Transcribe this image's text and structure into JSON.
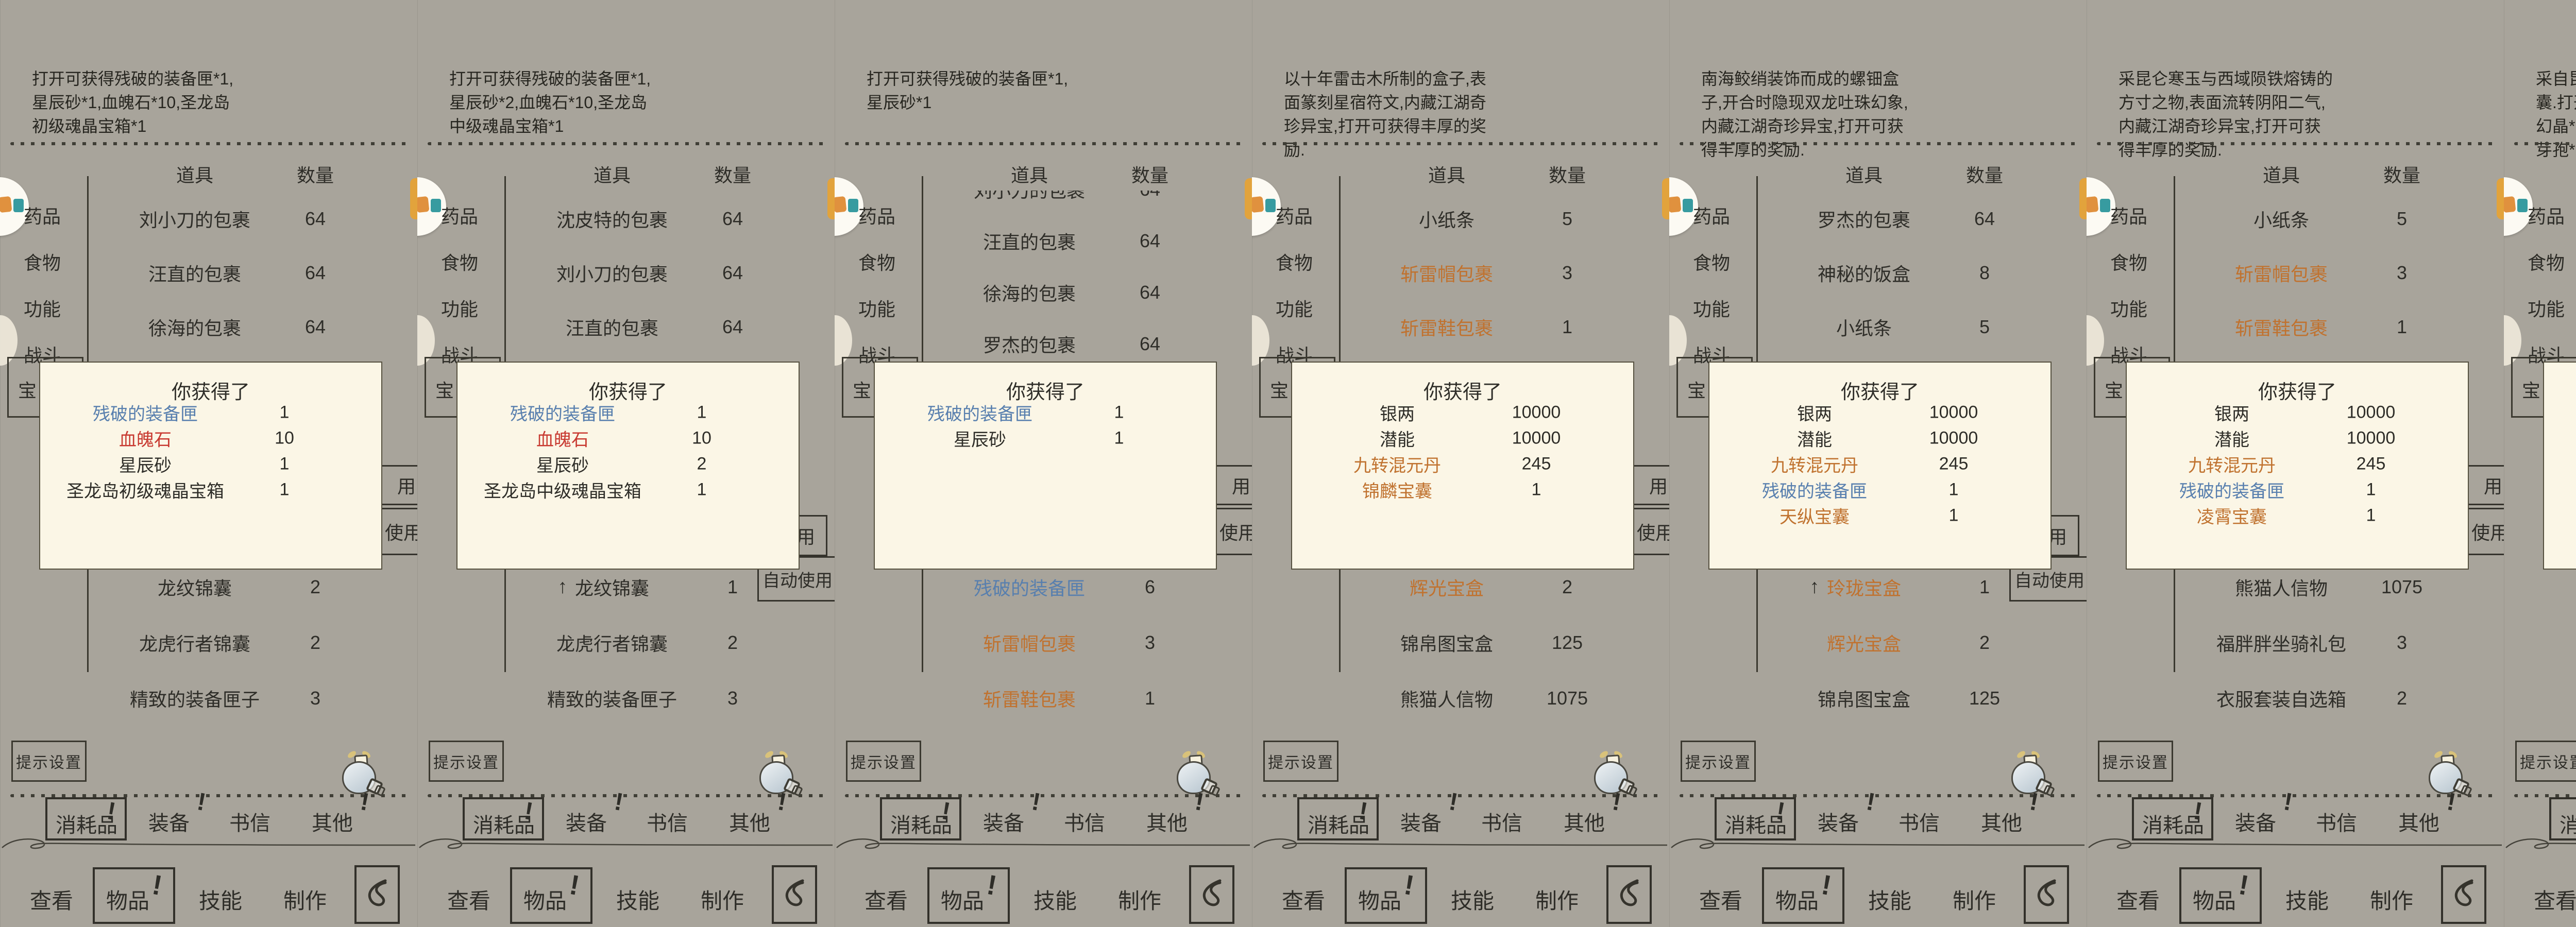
{
  "shared": {
    "table_header": {
      "item": "道具",
      "count": "数量"
    },
    "sidebar": [
      "药品",
      "食物",
      "功能",
      "战斗",
      "宝物"
    ],
    "popup_title": "你获得了",
    "use_button": "使用",
    "auto_use_button": "自动使用",
    "use_fragment": "用",
    "tip_settings_button": "提示设置",
    "tabs": [
      "消耗品",
      "装备",
      "书信",
      "其他"
    ],
    "bottom_tabs": [
      "查看",
      "物品",
      "技能",
      "制作"
    ],
    "alert_mark": "!",
    "selected_arrow": "↑",
    "colors": {
      "background": "#a8a49b",
      "popup_bg": "#fbf6e6",
      "ink": "#2e2d28",
      "item_blue": "#587fae",
      "item_orange": "#c0722f",
      "item_red": "#c83a31",
      "highlight": "#d2a878",
      "badge_orange": "#e0913e",
      "badge_teal": "#379ba0"
    }
  },
  "panels": [
    {
      "desc": "打开可获得残破的装备匣*1,星辰砂*1,血魄石*10,圣龙岛初级魂晶宝箱*1",
      "top": [
        [
          "刘小刀的包裹",
          "64",
          "k",
          ""
        ],
        [
          "汪直的包裹",
          "64",
          "k",
          ""
        ],
        [
          "徐海的包裹",
          "64",
          "k",
          ""
        ]
      ],
      "popup": [
        [
          "残破的装备匣",
          "1",
          "b"
        ],
        [
          "血魄石",
          "10",
          "r"
        ],
        [
          "星辰砂",
          "1",
          "k"
        ],
        [
          "圣龙岛初级魂晶宝箱",
          "1",
          "k"
        ]
      ],
      "lower": [
        [
          "龙纹锦囊",
          "2",
          "k",
          ""
        ],
        [
          "龙虎行者锦囊",
          "2",
          "k",
          ""
        ],
        [
          "精致的装备匣子",
          "3",
          "k",
          ""
        ]
      ],
      "buttons": "frag",
      "tab_alerts": [
        true,
        true,
        false,
        true
      ]
    },
    {
      "desc": "打开可获得残破的装备匣*1,星辰砂*2,血魄石*10,圣龙岛中级魂晶宝箱*1",
      "top": [
        [
          "沈皮特的包裹",
          "64",
          "k",
          ""
        ],
        [
          "刘小刀的包裹",
          "64",
          "k",
          ""
        ],
        [
          "汪直的包裹",
          "64",
          "k",
          ""
        ]
      ],
      "popup": [
        [
          "残破的装备匣",
          "1",
          "b"
        ],
        [
          "血魄石",
          "10",
          "r"
        ],
        [
          "星辰砂",
          "2",
          "k"
        ],
        [
          "圣龙岛中级魂晶宝箱",
          "1",
          "k"
        ]
      ],
      "lower": [
        [
          "龙纹锦囊",
          "1",
          "k",
          "sel"
        ],
        [
          "龙虎行者锦囊",
          "2",
          "k",
          ""
        ],
        [
          "精致的装备匣子",
          "3",
          "k",
          ""
        ]
      ],
      "buttons": "full_lower",
      "tab_alerts": [
        true,
        true,
        false,
        true
      ]
    },
    {
      "desc": "打开可获得残破的装备匣*1,星辰砂*1",
      "top": [
        [
          "刘小刀的包裹",
          "64",
          "k",
          "clip"
        ],
        [
          "汪直的包裹",
          "64",
          "k",
          ""
        ],
        [
          "徐海的包裹",
          "64",
          "k",
          ""
        ],
        [
          "罗杰的包裹",
          "64",
          "k",
          ""
        ]
      ],
      "popup": [
        [
          "残破的装备匣",
          "1",
          "b"
        ],
        [
          "星辰砂",
          "1",
          "k"
        ]
      ],
      "lower": [
        [
          "残破的装备匣",
          "6",
          "b",
          ""
        ],
        [
          "斩雷帽包裹",
          "3",
          "o",
          ""
        ],
        [
          "斩雷鞋包裹",
          "1",
          "o",
          ""
        ]
      ],
      "buttons": "frag",
      "tab_alerts": [
        true,
        true,
        false,
        true
      ]
    },
    {
      "desc": "以十年雷击木所制的盒子,表面篆刻星宿符文,内藏江湖奇珍异宝,打开可获得丰厚的奖励.",
      "top": [
        [
          "小纸条",
          "5",
          "k",
          ""
        ],
        [
          "斩雷帽包裹",
          "3",
          "o",
          ""
        ],
        [
          "斩雷鞋包裹",
          "1",
          "o",
          ""
        ]
      ],
      "popup": [
        [
          "银两",
          "10000",
          "k"
        ],
        [
          "潜能",
          "10000",
          "k"
        ],
        [
          "九转混元丹",
          "245",
          "o"
        ],
        [
          "锦麟宝囊",
          "1",
          "o"
        ]
      ],
      "lower": [
        [
          "辉光宝盒",
          "2",
          "o",
          ""
        ],
        [
          "锦帛图宝盒",
          "125",
          "k",
          ""
        ],
        [
          "熊猫人信物",
          "1075",
          "k",
          ""
        ]
      ],
      "buttons": "frag",
      "tab_alerts": [
        true,
        true,
        false,
        true
      ]
    },
    {
      "desc": "南海鲛绡装饰而成的螺钿盒子,开合时隐现双龙吐珠幻象,内藏江湖奇珍异宝,打开可获得丰厚的奖励.",
      "top": [
        [
          "罗杰的包裹",
          "64",
          "k",
          ""
        ],
        [
          "神秘的饭盒",
          "8",
          "k",
          ""
        ],
        [
          "小纸条",
          "5",
          "k",
          ""
        ]
      ],
      "popup": [
        [
          "银两",
          "10000",
          "k"
        ],
        [
          "潜能",
          "10000",
          "k"
        ],
        [
          "九转混元丹",
          "245",
          "o"
        ],
        [
          "残破的装备匣",
          "1",
          "b"
        ],
        [
          "天纵宝囊",
          "1",
          "o"
        ]
      ],
      "lower": [
        [
          "玲珑宝盒",
          "1",
          "o",
          "sel"
        ],
        [
          "辉光宝盒",
          "2",
          "o",
          ""
        ],
        [
          "锦帛图宝盒",
          "125",
          "k",
          ""
        ]
      ],
      "buttons": "full_lower",
      "tab_alerts": [
        true,
        true,
        false,
        true
      ]
    },
    {
      "desc": "采昆仑寒玉与西域陨铁熔铸的方寸之物,表面流转阴阳二气,内藏江湖奇珍异宝,打开可获得丰厚的奖励.",
      "top": [
        [
          "小纸条",
          "5",
          "k",
          ""
        ],
        [
          "斩雷帽包裹",
          "3",
          "o",
          ""
        ],
        [
          "斩雷鞋包裹",
          "1",
          "o",
          ""
        ]
      ],
      "popup": [
        [
          "银两",
          "10000",
          "k"
        ],
        [
          "潜能",
          "10000",
          "k"
        ],
        [
          "九转混元丹",
          "245",
          "o"
        ],
        [
          "残破的装备匣",
          "1",
          "b"
        ],
        [
          "凌霄宝囊",
          "1",
          "o"
        ]
      ],
      "lower": [
        [
          "熊猫人信物",
          "1075",
          "k",
          ""
        ],
        [
          "福胖胖坐骑礼包",
          "3",
          "k",
          ""
        ],
        [
          "衣服套装自选箱",
          "2",
          "k",
          ""
        ]
      ],
      "buttons": "frag",
      "tab_alerts": [
        true,
        true,
        false,
        true
      ]
    },
    {
      "desc": "采自昆仑绝顶冰髓雕琢的宝囊.打开可获得星辰砂*3,幽影幻晶*1,血魄石*20,西域灵芝芽孢*1,幽冥令*1.",
      "top": [
        [
          "凌霄宝囊",
          "1",
          "o",
          "sel"
        ],
        [
          "天纵宝囊",
          "2",
          "o",
          "alert"
        ],
        [
          "残破的装备匣",
          "4",
          "b",
          "alert"
        ]
      ],
      "popup": [
        [
          "西域灵芝芽孢",
          "1",
          "k"
        ],
        [
          "血魄石",
          "20",
          "r"
        ],
        [
          "星辰砂",
          "3",
          "k"
        ],
        [
          "幽影幻晶",
          "1",
          "k"
        ],
        [
          "幽冥令",
          "1",
          "r"
        ]
      ],
      "lower": [
        [
          "翻垛的包裹",
          "64",
          "k",
          ""
        ],
        [
          "炮头的包裹",
          "64",
          "k",
          ""
        ],
        [
          "水香的包裹",
          "64",
          "k",
          ""
        ]
      ],
      "buttons": "full_top",
      "tab_alerts": [
        true,
        true,
        false,
        true
      ]
    },
    {
      "desc": "此物由天蚕冰丝所制,囊面暗绣河洛星图.打开可获得星辰砂*2,幽影幻晶*1,血魄石*15,幽冥令*1.",
      "top": [
        [
          "天纵宝囊",
          "1",
          "o",
          "sel"
        ],
        [
          "残破的装备匣",
          "4",
          "b",
          "alert"
        ],
        [
          "锦麟宝囊",
          "2",
          "o",
          "alert"
        ]
      ],
      "popup": [
        [
          "血魄石",
          "15",
          "r"
        ],
        [
          "星辰砂",
          "2",
          "k"
        ],
        [
          "幽影幻晶",
          "1",
          "k"
        ],
        [
          "幽冥令",
          "1",
          "r"
        ]
      ],
      "lower": [
        [
          "炮头的包裹",
          "64",
          "k",
          ""
        ],
        [
          "水香的包裹",
          "64",
          "k",
          ""
        ],
        [
          "坐三雕的包裹",
          "64",
          "k",
          ""
        ]
      ],
      "buttons": "full_top",
      "tab_alerts": [
        false,
        true,
        false,
        true
      ]
    },
    {
      "desc": "此物以天青云锦为面,金丝捻线锁绣麒麟纹.打开可获得星辰砂*2,幽影幻晶*1,血魄石*12,幽冥令*1",
      "top": [
        [
          "残破的装备匣",
          "4",
          "b",
          "alert"
        ],
        [
          "锦麟宝囊",
          "1",
          "o",
          "sel"
        ],
        [
          "心一宝盒",
          "5",
          "k",
          ""
        ]
      ],
      "popup": [
        [
          "血魄石",
          "12",
          "r"
        ],
        [
          "星辰砂",
          "2",
          "k"
        ],
        [
          "幽影幻晶",
          "1",
          "k"
        ],
        [
          "幽冥令",
          "1",
          "r"
        ]
      ],
      "lower": [
        [
          "水香的包裹",
          "64",
          "k",
          ""
        ],
        [
          "坐三雕的包裹",
          "64",
          "k",
          ""
        ],
        [
          "黄金宝箱",
          "152",
          "k",
          ""
        ]
      ],
      "buttons": "full_top",
      "tab_alerts": [
        false,
        true,
        false,
        true
      ]
    }
  ]
}
